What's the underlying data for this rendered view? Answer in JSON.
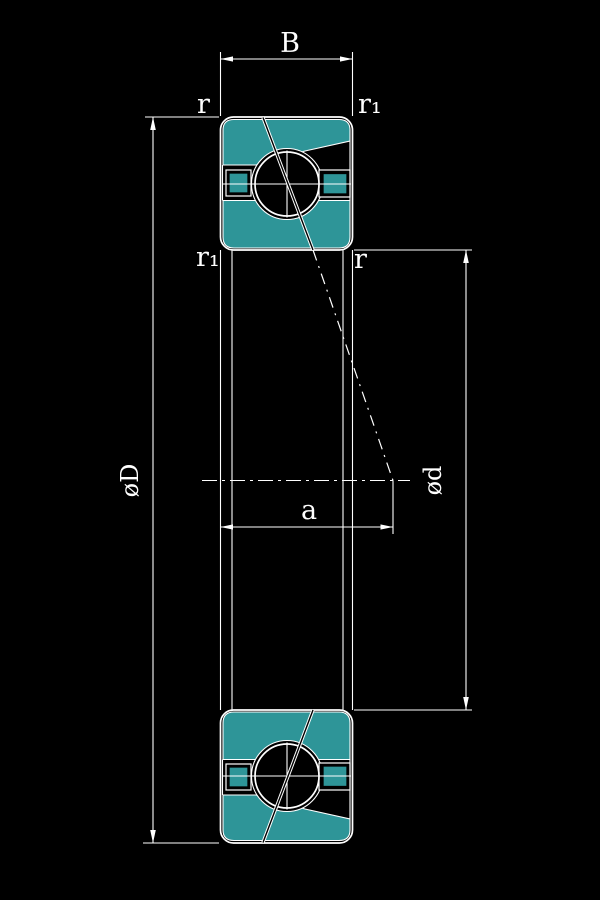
{
  "colors": {
    "background": "#000000",
    "lines": "#ffffff",
    "ring_fill": "#2e9598"
  },
  "labels": {
    "width": "B",
    "chamfer_top_left": "r",
    "chamfer_top_right": "r₁",
    "chamfer_mid_left": "r₁",
    "chamfer_mid_right": "r",
    "outer_diameter": "øD",
    "bore_diameter": "ød",
    "dimension_a": "a"
  }
}
